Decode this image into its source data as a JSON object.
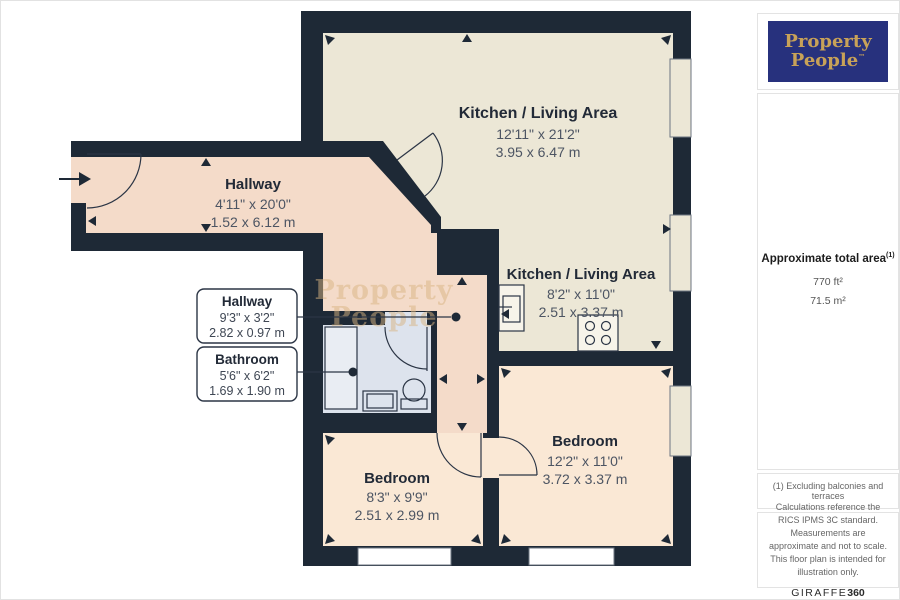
{
  "brand": {
    "logo_line1": "Property",
    "logo_line2": "People",
    "trademark": "™",
    "navy": "#27317d",
    "gold": "#c8a258"
  },
  "sidebar": {
    "area_title": "Approximate total area",
    "area_superscript": "(1)",
    "area_imperial": "770 ft²",
    "area_metric": "71.5 m²",
    "note": "(1) Excluding balconies and terraces",
    "disclaimer": "Calculations reference the RICS IPMS 3C standard. Measurements are approximate and not to scale. This floor plan is intended for illustration only.",
    "provider_name": "GIRAFFE",
    "provider_suffix": "360"
  },
  "floorplan": {
    "watermark_line1": "Property",
    "watermark_line2": "People",
    "rooms": [
      {
        "id": "kitchen-living-main",
        "name": "Kitchen / Living Area",
        "dims_imperial": "12'11\" x 21'2\"",
        "dims_metric": "3.95 x 6.47 m"
      },
      {
        "id": "kitchen-living-secondary",
        "name": "Kitchen / Living Area",
        "dims_imperial": "8'2\" x 11'0\"",
        "dims_metric": "2.51 x 3.37 m"
      },
      {
        "id": "hallway-main",
        "name": "Hallway",
        "dims_imperial": "4'11\" x 20'0\"",
        "dims_metric": "1.52 x 6.12 m"
      },
      {
        "id": "hallway-callout",
        "name": "Hallway",
        "dims_imperial": "9'3\" x 3'2\"",
        "dims_metric": "2.82 x 0.97 m"
      },
      {
        "id": "bathroom-callout",
        "name": "Bathroom",
        "dims_imperial": "5'6\" x 6'2\"",
        "dims_metric": "1.69 x 1.90 m"
      },
      {
        "id": "bedroom-1",
        "name": "Bedroom",
        "dims_imperial": "8'3\" x 9'9\"",
        "dims_metric": "2.51 x 2.99 m"
      },
      {
        "id": "bedroom-2",
        "name": "Bedroom",
        "dims_imperial": "12'2\" x 11'0\"",
        "dims_metric": "3.72 x 3.37 m"
      }
    ],
    "colors": {
      "wall": "#1e2936",
      "kitchen_floor": "#ece7d6",
      "hallway_floor": "#f4dbc9",
      "bedroom_floor": "#fae8d5",
      "bathroom_floor": "#dde3ed"
    }
  }
}
